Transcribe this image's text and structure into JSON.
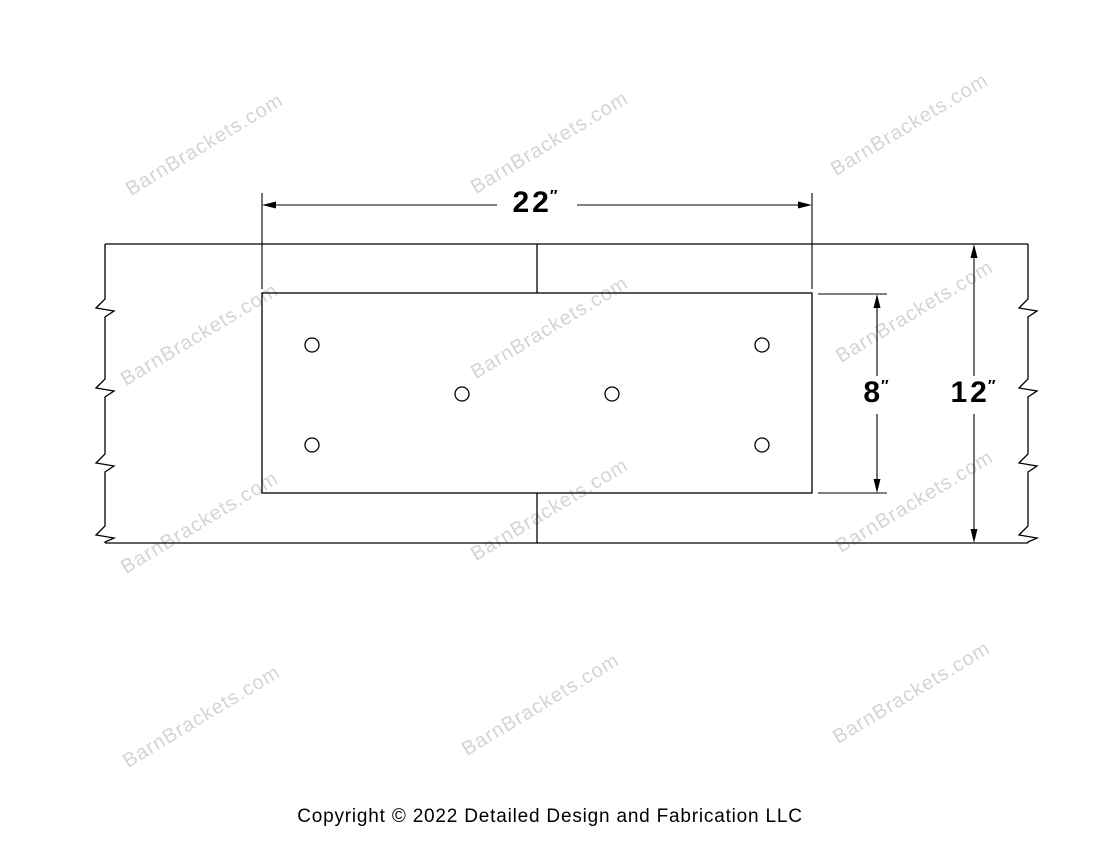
{
  "watermark": {
    "text": "BarnBrackets.com",
    "color": "#d4d4d4"
  },
  "drawing": {
    "line_color": "#000000",
    "bolt_hole_count": 6,
    "dim_plate_width": {
      "value": "22",
      "unit": "″"
    },
    "dim_plate_height": {
      "value": "8",
      "unit": "″"
    },
    "dim_beam_height": {
      "value": "12",
      "unit": "″"
    }
  },
  "footer": {
    "copyright_text": "Copyright © 2022 Detailed Design and Fabrication LLC"
  }
}
